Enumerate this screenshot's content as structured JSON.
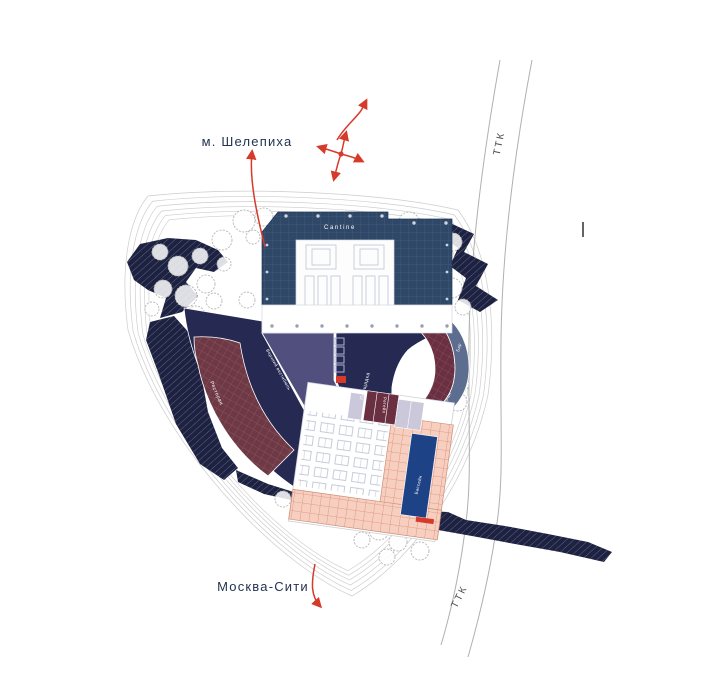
{
  "labels": {
    "metro": "м. Шелепиха",
    "city": "Москва-Сити",
    "road_top": "ТТК",
    "road_bottom": "ТТК"
  },
  "plan": {
    "cantine": "Cantine",
    "vestibule": "Верхний вестибюль",
    "plaza": "Площадка",
    "restaurant_left": "Ресторан",
    "retail_arc": "Ретейл",
    "bar": "Бар",
    "restaurant_arc": "Ресторан",
    "retail_lower": "Ретейл",
    "pool": "Бассейн"
  },
  "colors": {
    "navy_building": "#2f4868",
    "navy_dark": "#262a52",
    "berm": "#1d2242",
    "purple": "#504f7d",
    "maroon": "#6f3845",
    "maroon_dark": "#6b2f42",
    "blue_band": "#5c6d90",
    "teal": "#4b7383",
    "pool": "#1e4286",
    "terrace": "#f7cfc0",
    "terrace_line": "#d98b71",
    "lavender": "#cac8da",
    "red": "#d63a2a",
    "road": "#b0b0b0",
    "contour": "#cccccc",
    "tree": "#b6b6b6",
    "text_dark": "#233350"
  }
}
